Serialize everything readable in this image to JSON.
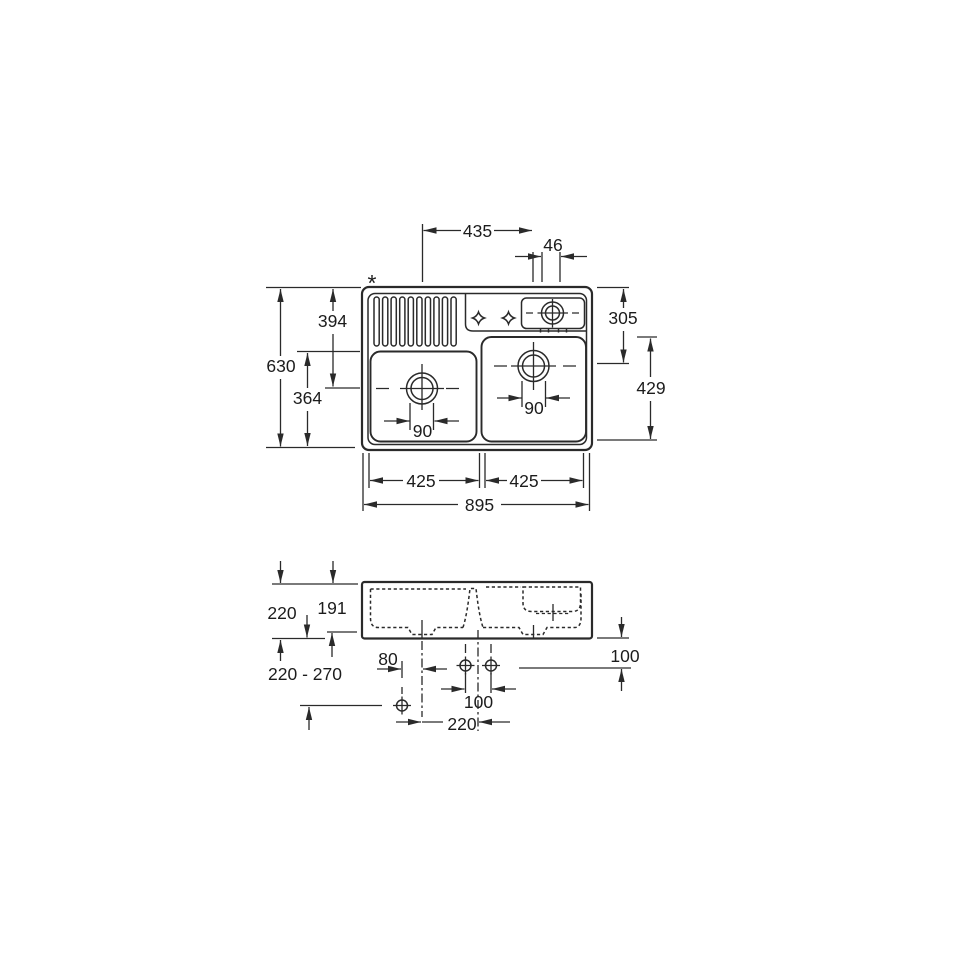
{
  "drawing_title": "sink-installation-dimension-drawing",
  "top_view": {
    "asterisk_note": "*",
    "dim_drain_spacing": "435",
    "dim_tap_hole_spacing": "46",
    "dim_overall_depth": "630",
    "dim_top_to_left_drain": "394",
    "dim_left_bowl_depth": "364",
    "dim_top_to_right_drain": "305",
    "dim_right_bowl_length": "429",
    "dim_left_drain_diameter": "90",
    "dim_right_drain_diameter": "90",
    "dim_left_bowl_width": "425",
    "dim_right_bowl_width": "425",
    "dim_overall_width": "895"
  },
  "side_view": {
    "dim_rim_height": "220",
    "dim_bowl_inner_depth": "191",
    "dim_mounting_range": "220 - 270",
    "dim_waste_offset": "80",
    "dim_rear_clearance": "100",
    "dim_hole_spacing": "100",
    "dim_drain_centre_spacing": "220"
  },
  "colors": {
    "line": "#2a2a2a",
    "text": "#1c1c1c",
    "background": "#ffffff"
  }
}
